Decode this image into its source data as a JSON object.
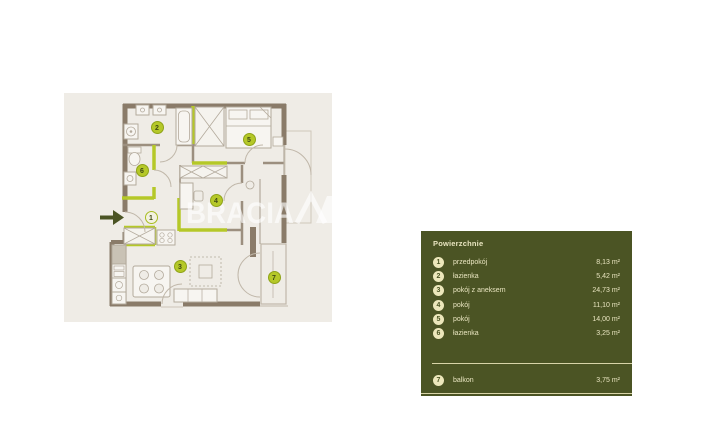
{
  "floor_plan": {
    "watermark_text": "BRACIA",
    "markers": {
      "m1": "1",
      "m2": "2",
      "m3": "3",
      "m4": "4",
      "m5": "5",
      "m6": "6",
      "m7": "7"
    }
  },
  "legend": {
    "title": "Powierzchnie",
    "rooms": [
      {
        "number": "1",
        "name": "przedpokój",
        "area": "8,13 m²"
      },
      {
        "number": "2",
        "name": "łazienka",
        "area": "5,42 m²"
      },
      {
        "number": "3",
        "name": "pokój z aneksem",
        "area": "24,73 m²"
      },
      {
        "number": "4",
        "name": "pokój",
        "area": "11,10 m²"
      },
      {
        "number": "5",
        "name": "pokój",
        "area": "14,00 m²"
      },
      {
        "number": "6",
        "name": "łazienka",
        "area": "3,25 m²"
      }
    ],
    "footer_rooms": [
      {
        "number": "7",
        "name": "balkon",
        "area": "3,75 m²"
      }
    ]
  },
  "colors": {
    "panel_bg": "#4b5424",
    "panel_text": "#e9e5c0",
    "accent_green": "#b5c828",
    "wall_brown": "#8a7b69",
    "plan_bg": "#efece6"
  }
}
